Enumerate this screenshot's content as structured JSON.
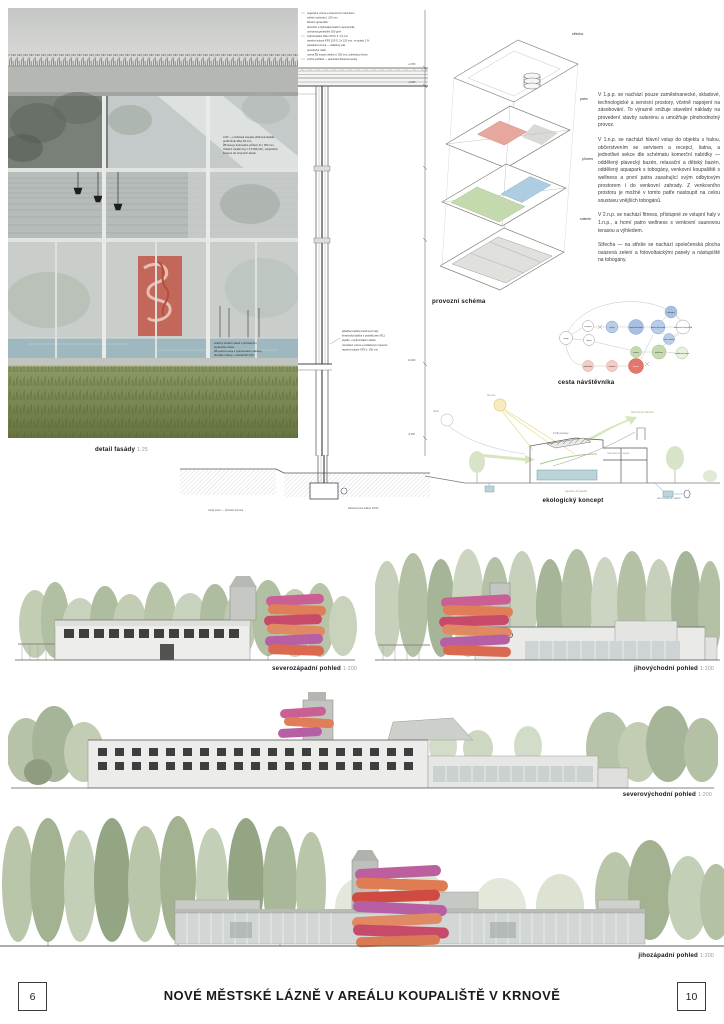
{
  "footer": {
    "page_left": "6",
    "page_right": "10",
    "title": "NOVÉ MĚSTSKÉ LÁZNĚ V AREÁLU KOUPALIŠTĚ V KRNOVĚ"
  },
  "panel_labels": {
    "detail": "detail fasády",
    "detail_scale": "1:25",
    "schema": "provozní schéma",
    "visitor": "cesta návštěvníka",
    "eco": "ekologický koncept",
    "elev_nw": "severozápadní pohled",
    "elev_nw_scale": "1:200",
    "elev_se": "jihovýchodní pohled",
    "elev_se_scale": "1:200",
    "elev_ne": "severovýchodní pohled",
    "elev_ne_scale": "1:200",
    "elev_sw": "jihozápadní pohled",
    "elev_sw_scale": "1:200"
  },
  "axon_labels": {
    "roof": "střecha",
    "floor": "patro",
    "ground": "přízemí",
    "basement": "suterén"
  },
  "description": {
    "p1": "V 1.p.p. se nachází pouze zaměstnanecké, skladové, technologické a servisní prostory, včetně napojení na zásobování. To výrazně snižuje stavební náklady na provedení stavby suterénu a umožňuje plnohodnotný provoz.",
    "p2": "V 1.n.p. se nachází hlavní vstup do objektu s halou, občerstvením se servisem a recepcí, šatna, a jednotlivé sekce dle schématu komerční nabídky — oddělený plavecký bazén, relaxační a dětský bazén, oddělený aquapark s tobogány, venkovní koupaliště s wellness a první patra zasahující svým odbytovým prostorem i do venkovní zahrady. Z venkovního prostoru je možné v tomto patře nastoupit na celou soustavu vnějších tobogánů.",
    "p3": "V 2.n.p. se nachází fitness, přístupné ze vstupní haly v 1.n.p., a horní patro wellness s venkovní saunovou terasou a výhledem.",
    "p4": "Střecha — na střeše se nachází společenská plocha osázená zelení a fotovoltaickými panely a nástupiště na tobogány."
  },
  "detail_annotations": {
    "roof_layers": [
      "vegetační vrstva s extenzivním trávníkem",
      "střešní substrát tl. 100 mm",
      "filtrační geotextilie",
      "drenážní a hydroakumulační nopová fólie",
      "ochranná geotextilie 300 g/m²",
      "hydroizolační fólie mPVC tl. 1,5 mm",
      "tepelná izolace EPS 150 S, 2× 120 mm, ve spádu 2 %",
      "parotěsná vrstva — asfaltový pás",
      "penetrační nátěr",
      "nosná ŽB stropní deska tl. 250 mm, pohledový beton",
      "vnitřní podhled — akustické dřevěné lamely"
    ],
    "facade_note": [
      "LOP — modulová sloupko-příčková fasáda,",
      "profil hliník šířky 60 mm,",
      "ŽB sloupy kruhového průřezu D = 350 mm,",
      "Izolační trojsklo Ug = 0,5 W/(m²K), celoplošně",
      "kotvené do stropních desek"
    ],
    "mid_note": [
      "skladba podlahy bazénové haly:",
      "keramická dlažba s protiskluzem R11",
      "lepidlo + hydroizolační stěrka",
      "roznášecí vrstva s podlahovým topením",
      "tepelná izolace XPS tl. 160 mm"
    ],
    "base_note": [
      "soklový izolační panel s přerušením",
      "tepelného mostu,",
      "ŽB opěrná vana s hydroizolační stěrkou,",
      "drenážní násyp + drenáž DN 100"
    ],
    "ground_note": "rostlý terén — původní zemina",
    "ground_note2": "štěrkové lože frakce 16/32",
    "dims": [
      "+4,550",
      "+3,950",
      "±0,000",
      "-0,450"
    ]
  },
  "flow": {
    "labels": [
      "vstup",
      "recepce",
      "šatna",
      "šatny",
      "bazénová hala",
      "plavecký bazén",
      "tobogán",
      "relax. bazén",
      "venkovní koupaliště",
      "sauna",
      "wellness",
      "venkovní terasa",
      "pokladna",
      "zázemí",
      "fitness"
    ]
  },
  "eco_labels": {
    "sun": "slunce",
    "rain": "déšť",
    "pv": "FVE panely",
    "vent": "přirozené větrání",
    "rekuperace": "rekuperace tepla",
    "tank": "akumulační nádrž",
    "pump": "tepelné čerpadlo"
  },
  "colors": {
    "slide_pink": "#c95f93",
    "slide_magenta": "#b75fa5",
    "slide_orange": "#df7e58",
    "slide_red": "#c84a6b",
    "diagram_blue": "#b9cce8",
    "diagram_green": "#c6dcb0",
    "diagram_red": "#e2776b",
    "pool_blue": "#9fb8bf",
    "grass_green": "#77884f",
    "poster_red": "#c4675b"
  }
}
